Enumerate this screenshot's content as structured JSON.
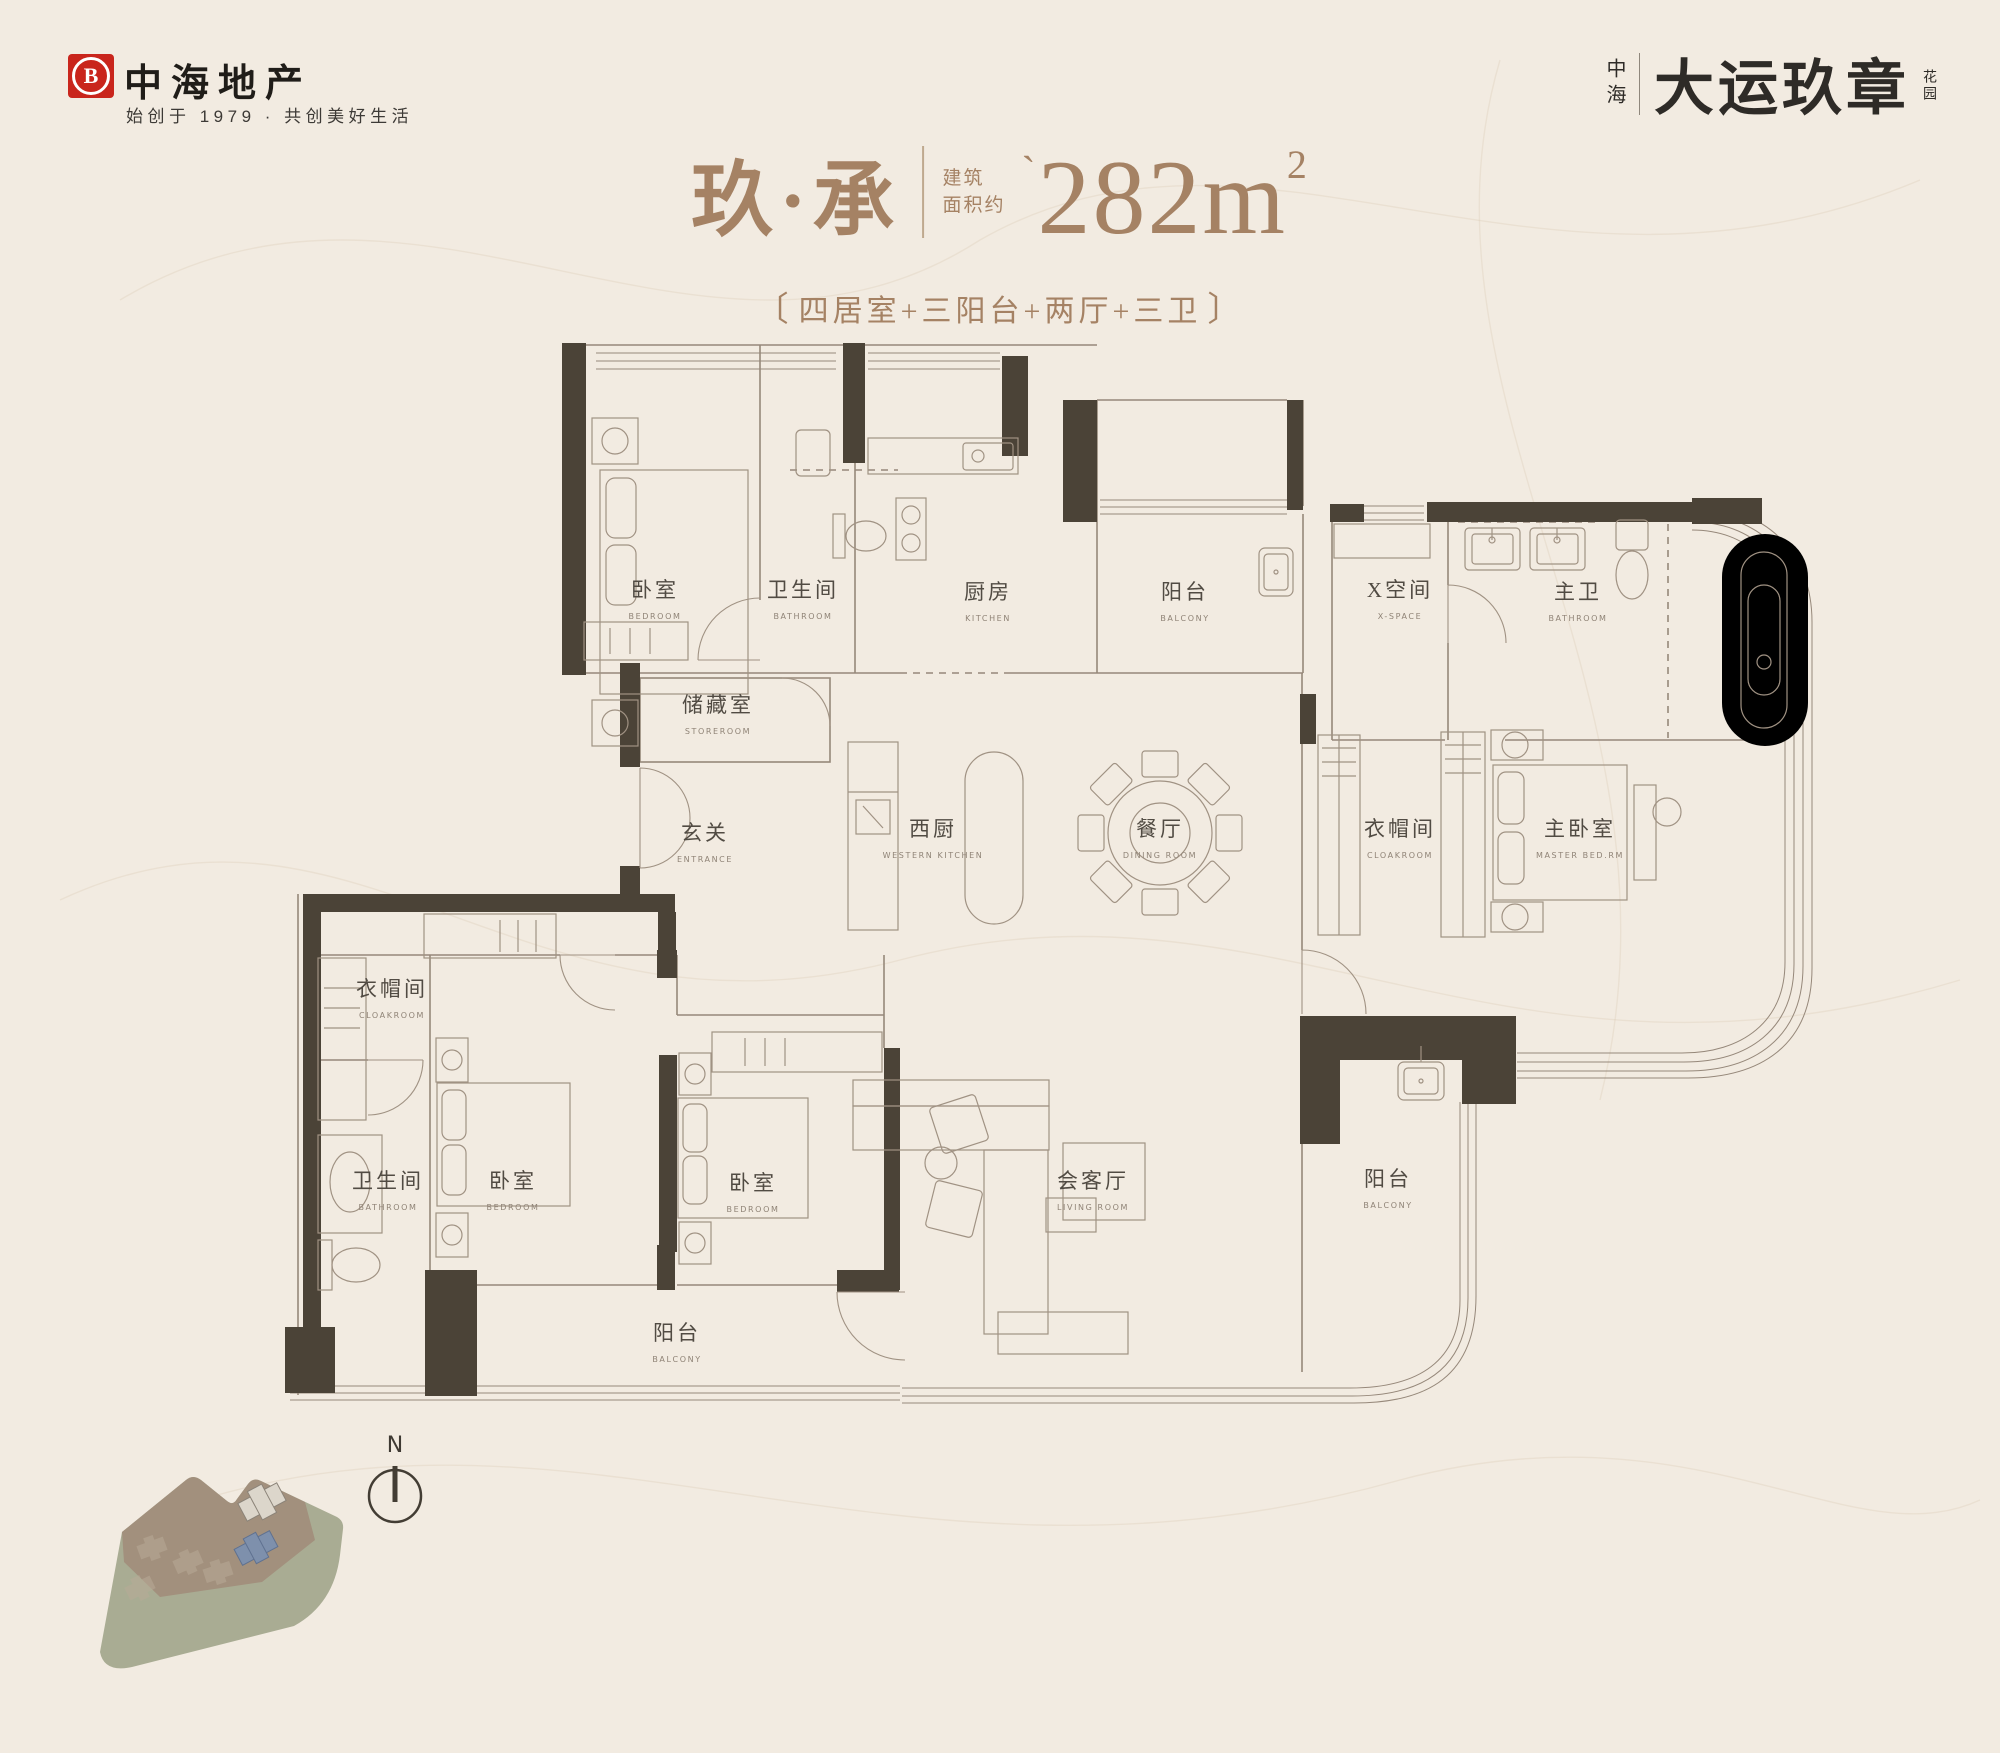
{
  "page": {
    "width": 2000,
    "height": 1753,
    "bg": "#f2ebe1"
  },
  "header": {
    "logo": {
      "badge_letter": "B",
      "red": "#c9251c",
      "brand": "中海地产",
      "tagline": "始创于 1979 · 共创美好生活"
    },
    "project": {
      "prefix": "中海",
      "name": "大运玖章",
      "suffix": "花园"
    }
  },
  "title": {
    "accent": "#a58264",
    "unit_name": "玖·承",
    "area_label_line1": "建筑",
    "area_label_line2": "面积约",
    "area_tick": "`",
    "area_value": "282",
    "area_unit": "m",
    "area_sup": "2",
    "bracket_left": "〔",
    "bracket_right": "〕",
    "subtitle": "四居室+三阳台+两厅+三卫"
  },
  "floorplan": {
    "wall_color": "#4b4337",
    "line_color": "#96887a",
    "rooms": [
      {
        "id": "bedroom-1",
        "zh": "卧室",
        "en": "BEDROOM",
        "x": 655,
        "y": 597
      },
      {
        "id": "bath-1",
        "zh": "卫生间",
        "en": "BATHROOM",
        "x": 803,
        "y": 597
      },
      {
        "id": "kitchen",
        "zh": "厨房",
        "en": "KITCHEN",
        "x": 988,
        "y": 599
      },
      {
        "id": "balcony-north",
        "zh": "阳台",
        "en": "BALCONY",
        "x": 1185,
        "y": 599
      },
      {
        "id": "x-space",
        "zh": "X空间",
        "en": "X-SPACE",
        "x": 1400,
        "y": 597
      },
      {
        "id": "master-bath",
        "zh": "主卫",
        "en": "BATHROOM",
        "x": 1578,
        "y": 599
      },
      {
        "id": "storage",
        "zh": "储藏室",
        "en": "STOREROOM",
        "x": 718,
        "y": 712
      },
      {
        "id": "entrance",
        "zh": "玄关",
        "en": "ENTRANCE",
        "x": 705,
        "y": 840
      },
      {
        "id": "western-kitchen",
        "zh": "西厨",
        "en": "WESTERN KITCHEN",
        "x": 933,
        "y": 836
      },
      {
        "id": "dining",
        "zh": "餐厅",
        "en": "DINING ROOM",
        "x": 1160,
        "y": 836
      },
      {
        "id": "cloakroom-master",
        "zh": "衣帽间",
        "en": "CLOAKROOM",
        "x": 1400,
        "y": 836
      },
      {
        "id": "master-bedroom",
        "zh": "主卧室",
        "en": "MASTER BED.RM",
        "x": 1580,
        "y": 836
      },
      {
        "id": "cloakroom-2",
        "zh": "衣帽间",
        "en": "CLOAKROOM",
        "x": 392,
        "y": 996
      },
      {
        "id": "bath-2",
        "zh": "卫生间",
        "en": "BATHROOM",
        "x": 388,
        "y": 1188
      },
      {
        "id": "bedroom-2",
        "zh": "卧室",
        "en": "BEDROOM",
        "x": 513,
        "y": 1188
      },
      {
        "id": "bedroom-3",
        "zh": "卧室",
        "en": "BEDROOM",
        "x": 753,
        "y": 1190
      },
      {
        "id": "living",
        "zh": "会客厅",
        "en": "LIVING ROOM",
        "x": 1093,
        "y": 1188
      },
      {
        "id": "balcony-east",
        "zh": "阳台",
        "en": "BALCONY",
        "x": 1388,
        "y": 1186
      },
      {
        "id": "balcony-south",
        "zh": "阳台",
        "en": "BALCONY",
        "x": 677,
        "y": 1340
      }
    ]
  },
  "compass": {
    "label": "N"
  },
  "sitemap": {
    "green": "#a9ac93",
    "brown": "#a2907d",
    "highlight": "#7e90ac",
    "building_gray": "#dcd6cb"
  }
}
